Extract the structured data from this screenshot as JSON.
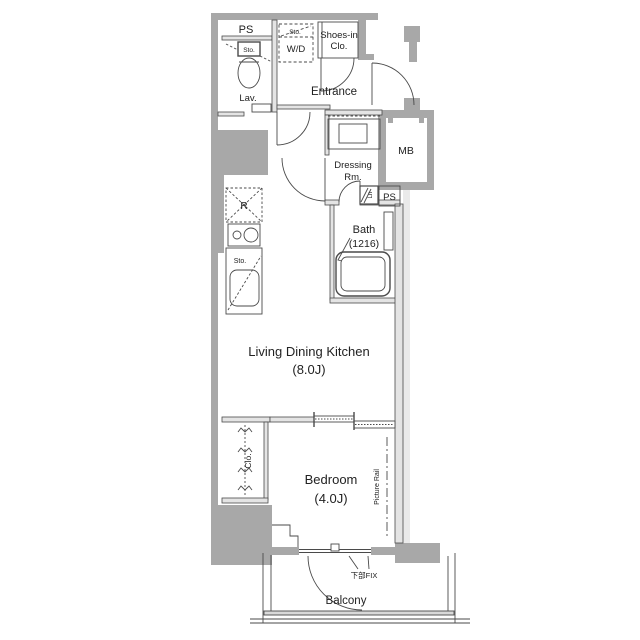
{
  "colors": {
    "wall": "#a8a8a8",
    "wall_light": "#e4e4e4",
    "line": "#4a4a4a",
    "text": "#222222",
    "background": "#ffffff"
  },
  "rooms": {
    "ps_top": {
      "label": "PS"
    },
    "lavatory": {
      "label": "Lav.",
      "tank_label": "Sto."
    },
    "washer_dryer": {
      "label": "W/D",
      "storage_label": "Sto."
    },
    "shoes_closet": {
      "label_line1": "Shoes-in",
      "label_line2": "Clo."
    },
    "entrance": {
      "label": "Entrance"
    },
    "dressing_room": {
      "label_line1": "Dressing",
      "label_line2": "Rm."
    },
    "meter_box": {
      "label": "MB"
    },
    "ps_mid": {
      "label": "PS"
    },
    "linen_box": {
      "label": "Ln"
    },
    "bath": {
      "label": "Bath",
      "size": "(1216)"
    },
    "kitchen": {
      "fridge_label": "R",
      "storage_label": "Sto."
    },
    "ldk": {
      "label": "Living Dining Kitchen",
      "size": "(8.0J)"
    },
    "bedroom": {
      "label": "Bedroom",
      "size": "(4.0J)"
    },
    "closet": {
      "label": "Clo."
    },
    "picture_rail": {
      "label": "Picture Rail"
    },
    "balcony": {
      "label": "Balcony",
      "fix_window_label": "下部FIX"
    }
  }
}
